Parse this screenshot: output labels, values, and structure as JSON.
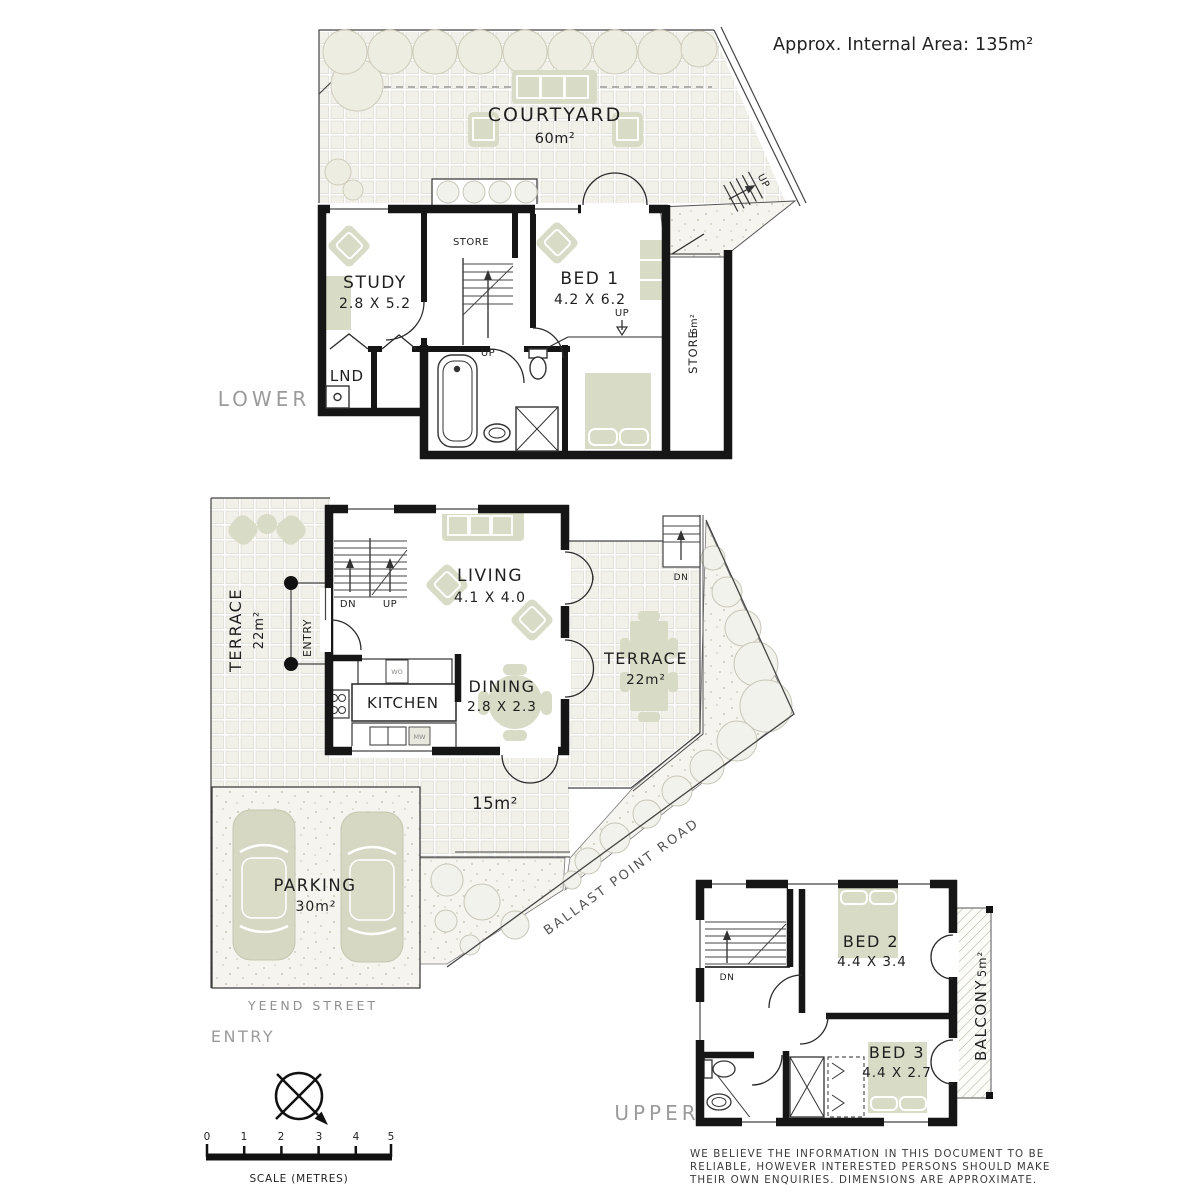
{
  "colors": {
    "wall": "#161616",
    "furniture": "#d8dbc6",
    "tile": "#f1f0e9",
    "bush": "#f2f2ec",
    "level_label_gray": "#9b9b9b"
  },
  "header": {
    "internal_area_label": "Approx. Internal Area: 135m²"
  },
  "lower": {
    "level_label": "LOWER",
    "courtyard_name": "COURTYARD",
    "courtyard_area": "60m²",
    "study_name": "STUDY",
    "study_dims": "2.8 X 5.2",
    "store_name": "STORE",
    "stairs_up_label": "UP",
    "bed1_name": "BED 1",
    "bed1_dims": "4.2 X 6.2",
    "bed1_step_label": "UP",
    "external_stairs_label": "UP",
    "laundry_name": "LND",
    "side_store_name": "STORE",
    "side_store_area": "6m²"
  },
  "ground": {
    "terrace_left_name": "TERRACE",
    "terrace_left_area": "22m²",
    "entry_porch_label": "ENTRY",
    "stairs_dn_label": "DN",
    "stairs_up_label": "UP",
    "living_name": "LIVING",
    "living_dims": "4.1 X 4.0",
    "kitchen_name": "KITCHEN",
    "oven_label": "WO",
    "microwave_label": "MW",
    "dining_name": "DINING",
    "dining_dims": "2.8 X 2.3",
    "terrace_right_name": "TERRACE",
    "terrace_right_area": "22m²",
    "terrace_stairs_dn_label": "DN",
    "path_area_label": "15m²",
    "parking_name": "PARKING",
    "parking_area": "30m²",
    "street_name": "YEEND STREET",
    "entry_label": "ENTRY",
    "road_name": "BALLAST POINT ROAD"
  },
  "upper": {
    "level_label": "UPPER",
    "stairs_dn_label": "DN",
    "bed2_name": "BED 2",
    "bed2_dims": "4.4 X 3.4",
    "bed3_name": "BED 3",
    "bed3_dims": "4.4 X 2.7",
    "balcony_name": "BALCONY",
    "balcony_area": "5m²"
  },
  "footer": {
    "scale_ticks": [
      "0",
      "1",
      "2",
      "3",
      "4",
      "5"
    ],
    "scale_caption": "SCALE (METRES)",
    "disclaimer_lines": [
      "WE BELIEVE THE INFORMATION IN THIS DOCUMENT TO BE",
      "RELIABLE, HOWEVER INTERESTED PERSONS SHOULD MAKE",
      "THEIR OWN ENQUIRIES. DIMENSIONS ARE APPROXIMATE."
    ]
  }
}
